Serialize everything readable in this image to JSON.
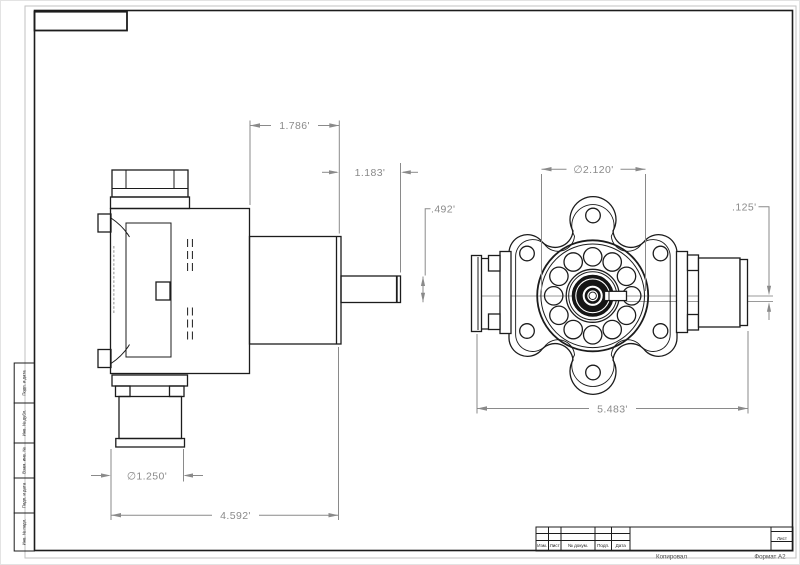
{
  "drawing": {
    "side_view": {
      "dim_top_width": "1.786'",
      "dim_shaft_length": "1.183'",
      "dim_shaft_dia": ".492'",
      "dim_hose_dia": "∅1.250'",
      "dim_overall": "4.592'"
    },
    "front_view": {
      "dim_bearing_dia": "∅2.120'",
      "dim_step": ".125'",
      "dim_overall": "5.483'"
    },
    "title_block": {
      "col_izm": "Изм.",
      "col_list": "Лист",
      "col_doc": "№ докум.",
      "col_podp": "Подп.",
      "col_data": "Дата",
      "sheet_label": "Лист",
      "footer_copy": "Копировал",
      "footer_format": "Формат А2"
    },
    "margin_strip": {
      "box1": "Подп. и дата",
      "box2": "Инв. № дубл.",
      "box3": "Взам. инв. №",
      "box4": "Подп. и дата",
      "box5": "Инв. № подл."
    },
    "colors": {
      "object_line": "#1c1c1c",
      "dimension_line": "#8a8a8a",
      "paper": "#ffffff"
    }
  }
}
